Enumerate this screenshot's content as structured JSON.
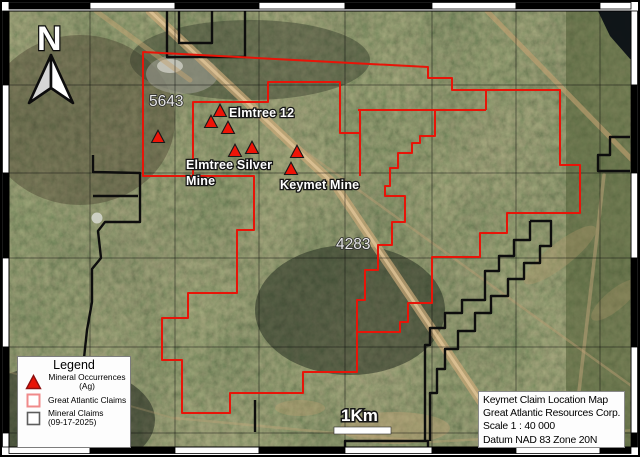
{
  "map": {
    "north_label": "N",
    "scale_bar_label": "1Km",
    "labels": {
      "claim_5643": "5643",
      "claim_4283": "4283",
      "elmtree12": "Elmtree 12",
      "elmtree_silver_line1": "Elmtree Silver",
      "elmtree_silver_line2": "Mine",
      "keymet_mine": "Keymet Mine"
    },
    "colors": {
      "great_atlantic_claims_red": "#e81408",
      "mineral_claims_black": "#0d0d0d",
      "occurrence_red": "#ee1407"
    },
    "markers": [
      {
        "x": 158,
        "y": 137
      },
      {
        "x": 211,
        "y": 122
      },
      {
        "x": 220,
        "y": 111
      },
      {
        "x": 228,
        "y": 128
      },
      {
        "x": 235,
        "y": 151
      },
      {
        "x": 252,
        "y": 148
      },
      {
        "x": 297,
        "y": 152
      },
      {
        "x": 291,
        "y": 169
      }
    ]
  },
  "legend": {
    "title": "Legend",
    "items": [
      {
        "icon": "red-triangle-icon",
        "line1": "Mineral Occurrences",
        "line2": "(Ag)"
      },
      {
        "icon": "red-outline-square-icon",
        "line1": "Great Atlantic Claims",
        "line2": ""
      },
      {
        "icon": "black-outline-square-icon",
        "line1": "Mineral Claims",
        "line2": "(09-17-2025)"
      }
    ]
  },
  "info_box": {
    "line1": "Keymet Claim Location Map",
    "line2": "Great Atlantic Resources Corp.",
    "line3": "Scale 1 : 40 000",
    "line4": "Datum NAD 83 Zone 20N"
  }
}
